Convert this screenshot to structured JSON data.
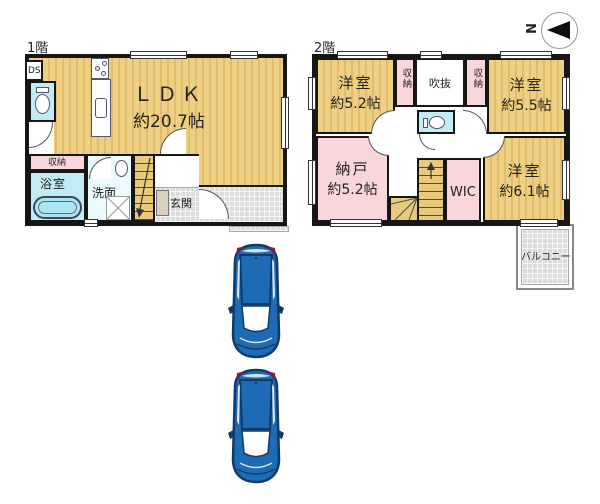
{
  "palette": {
    "wall": "#161616",
    "flooring_light": "#edd083",
    "flooring_dark": "#e2bb6c",
    "room_pink": "#f8d6da",
    "wet_area_cyan": "#c2ecf4",
    "tile_grey": "#dcdcdc",
    "car_blue": "#1c6bb4",
    "car_navy": "#123a66",
    "car_red": "#9b1b2e"
  },
  "compass": {
    "north_label": "N"
  },
  "floor1": {
    "label": "1階",
    "ldk": {
      "name": "ＬＤＫ",
      "size": "約20.7帖"
    },
    "ds": "DS",
    "storage": "収納",
    "bath": "浴室",
    "washroom": "洗面",
    "entrance": "玄関"
  },
  "floor2": {
    "label": "2階",
    "bedroom_nw": {
      "name": "洋室",
      "size": "約5.2帖"
    },
    "closet_left": "収納",
    "void": "吹抜",
    "closet_right": "収納",
    "bedroom_ne": {
      "name": "洋室",
      "size": "約5.5帖"
    },
    "storage_room": {
      "name": "納戸",
      "size": "約5.2帖"
    },
    "wic": "WIC",
    "bedroom_se": {
      "name": "洋室",
      "size": "約6.1帖"
    },
    "balcony": "バルコニー"
  }
}
